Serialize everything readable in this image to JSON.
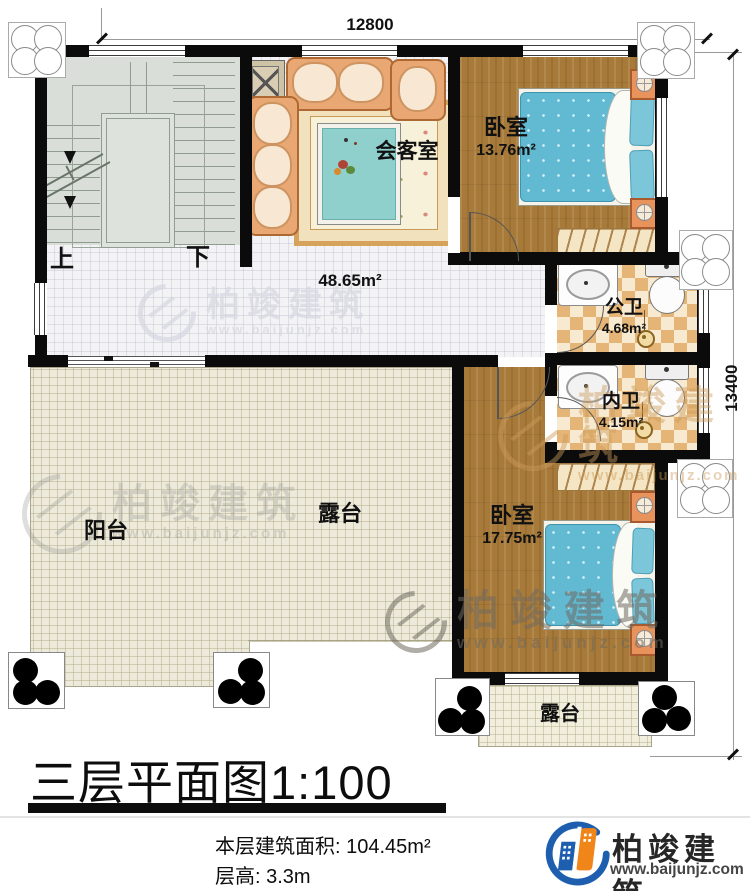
{
  "dimensions": {
    "width": "12800",
    "height": "13400"
  },
  "stairs": {
    "up": "上",
    "down": "下"
  },
  "rooms": {
    "reception": {
      "name": "会客室"
    },
    "hall": {
      "area": "48.65m²"
    },
    "bedroom_top": {
      "name": "卧室",
      "area": "13.76m²"
    },
    "public_bath": {
      "name": "公卫",
      "area": "4.68m²"
    },
    "ensuite_bath": {
      "name": "内卫",
      "area": "4.15m²"
    },
    "bedroom_bottom": {
      "name": "卧室",
      "area": "17.75m²"
    },
    "balcony": {
      "name": "阳台"
    },
    "terrace_main": {
      "name": "露台"
    },
    "terrace_small": {
      "name": "露台"
    }
  },
  "title_block": {
    "title": "三层平面图1:100",
    "floor_area_label": "本层建筑面积:",
    "floor_area_value": "104.45m²",
    "floor_height_label": "层高:",
    "floor_height_value": "3.3m"
  },
  "brand": {
    "name": "柏竣建筑",
    "url": "www.baijunjz.com"
  },
  "watermark": {
    "name": "柏竣建筑",
    "url": "www.baijunjz.com"
  },
  "colors": {
    "accent_blue": "#1d5fae",
    "accent_orange": "#f08519",
    "wall": "#0b0b0b"
  }
}
